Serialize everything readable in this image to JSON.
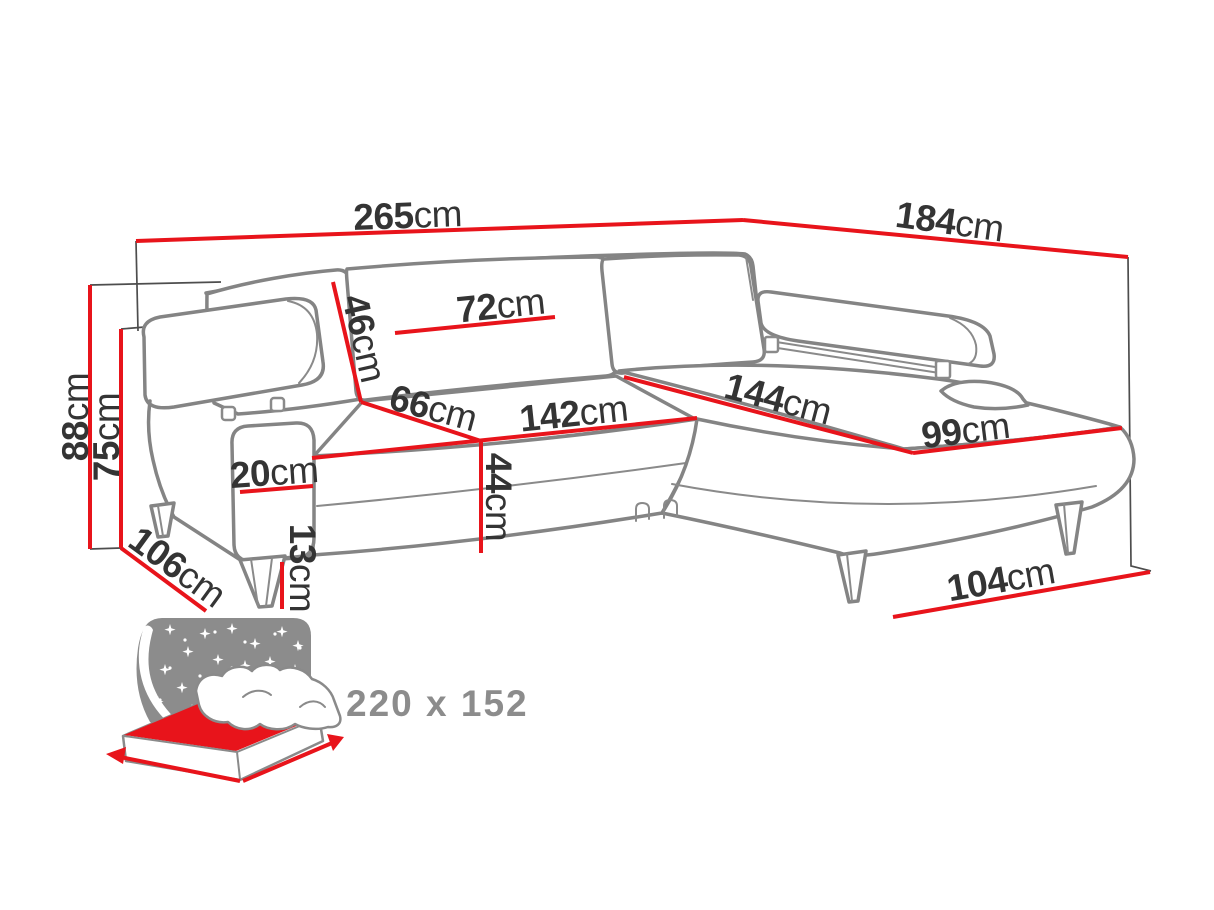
{
  "diagram_title": "corner-sofa-dimension-diagram",
  "colors": {
    "dimension_red": "#e8141b",
    "outline_grey": "#848484",
    "label_dark": "#343434",
    "icon_grey": "#8c8c8c"
  },
  "labels": {
    "total_width": {
      "value": "265",
      "unit": "cm"
    },
    "total_depth": {
      "value": "184",
      "unit": "cm"
    },
    "total_height": {
      "value": "88",
      "unit": "cm"
    },
    "backrest_height": {
      "value": "75",
      "unit": "cm"
    },
    "back_cushion_height": {
      "value": "46",
      "unit": "cm"
    },
    "back_cushion_width": {
      "value": "72",
      "unit": "cm"
    },
    "seat_depth": {
      "value": "66",
      "unit": "cm"
    },
    "seat_length": {
      "value": "142",
      "unit": "cm"
    },
    "chaise_length": {
      "value": "144",
      "unit": "cm"
    },
    "chaise_width": {
      "value": "99",
      "unit": "cm"
    },
    "armrest_width": {
      "value": "20",
      "unit": "cm"
    },
    "seat_height": {
      "value": "44",
      "unit": "cm"
    },
    "leg_height": {
      "value": "13",
      "unit": "cm"
    },
    "side_depth": {
      "value": "106",
      "unit": "cm"
    },
    "chaise_outer_length": {
      "value": "104",
      "unit": "cm"
    }
  },
  "sleeping_area": {
    "size": "220 x 152"
  }
}
